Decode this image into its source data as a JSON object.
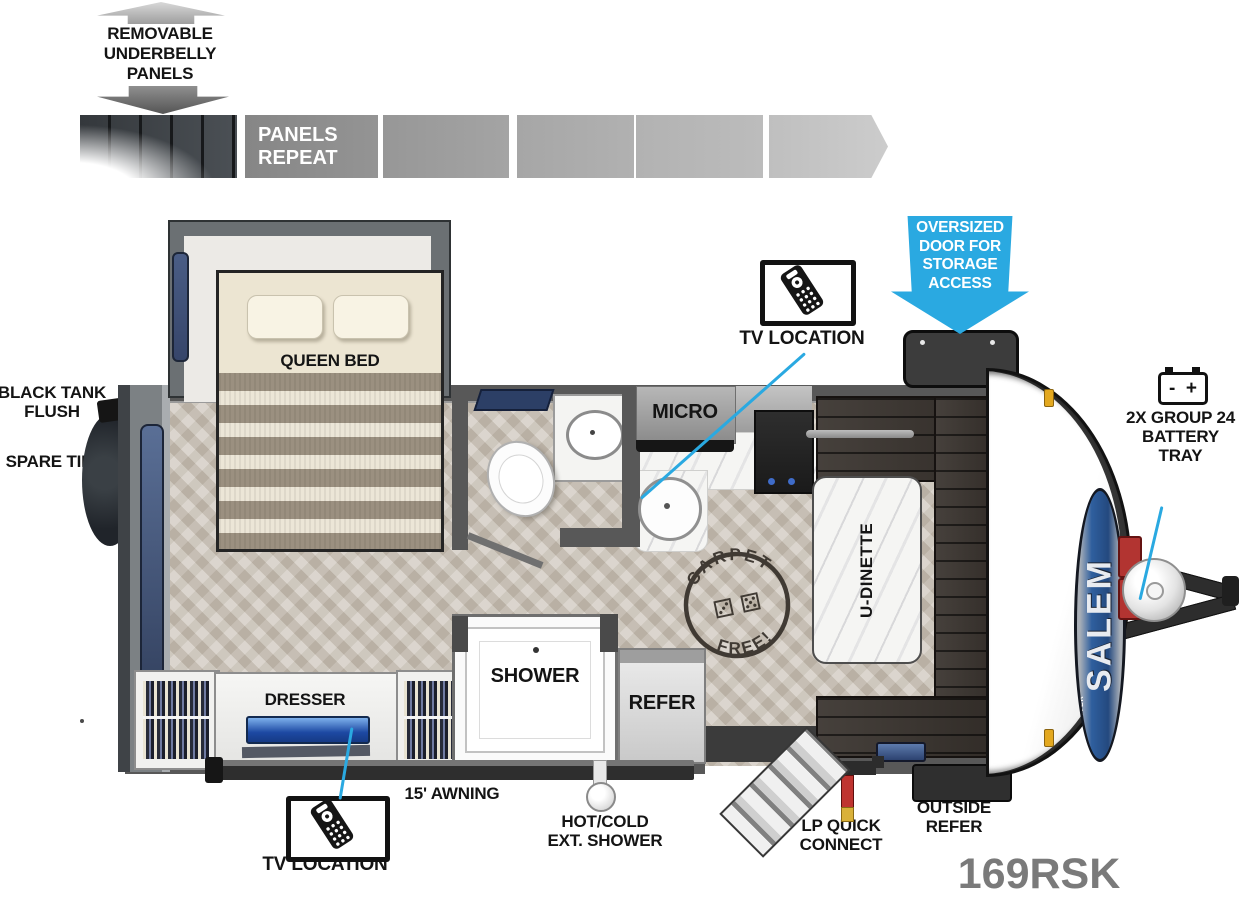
{
  "colors": {
    "accent_blue": "#2aa9e1",
    "wall_gray": "#585858",
    "model_gray": "#7a7a7a",
    "window_navy": "#3d4f74",
    "dinette_brown": "#38322d",
    "battery_red": "#b23431"
  },
  "legend": {
    "underbelly": [
      "REMOVABLE",
      "UNDERBELLY",
      "PANELS"
    ],
    "panels_repeat": [
      "PANELS",
      "REPEAT"
    ]
  },
  "outside": {
    "black_tank_flush": [
      "BLACK TANK",
      "FLUSH"
    ],
    "spare_tire": "SPARE TIRE",
    "tv_location": "TV LOCATION",
    "oversized_door": [
      "OVERSIZED",
      "DOOR FOR",
      "STORAGE",
      "ACCESS"
    ],
    "battery_tray": [
      "2X GROUP 24",
      "BATTERY",
      "TRAY"
    ],
    "battery_minus": "-",
    "battery_plus": "+",
    "awning": "15' AWNING",
    "ext_shower": [
      "HOT/COLD",
      "EXT. SHOWER"
    ],
    "lp_quick_connect": [
      "LP QUICK",
      "CONNECT"
    ],
    "outside_refer": [
      "OUTSIDE",
      "REFER"
    ],
    "model": "169RSK"
  },
  "interior": {
    "queen_bed": "QUEEN BED",
    "micro": "MICRO",
    "u_dinette": "U-DINETTE",
    "dresser": "DRESSER",
    "shower": "SHOWER",
    "refer": "REFER"
  },
  "stamp": {
    "arc_top": "CARPET",
    "arc_bottom": "FREE!",
    "icons": "⚂ ⚄"
  },
  "branding": {
    "salem": "SALEM",
    "forest_river": "FOREST RIVER"
  }
}
